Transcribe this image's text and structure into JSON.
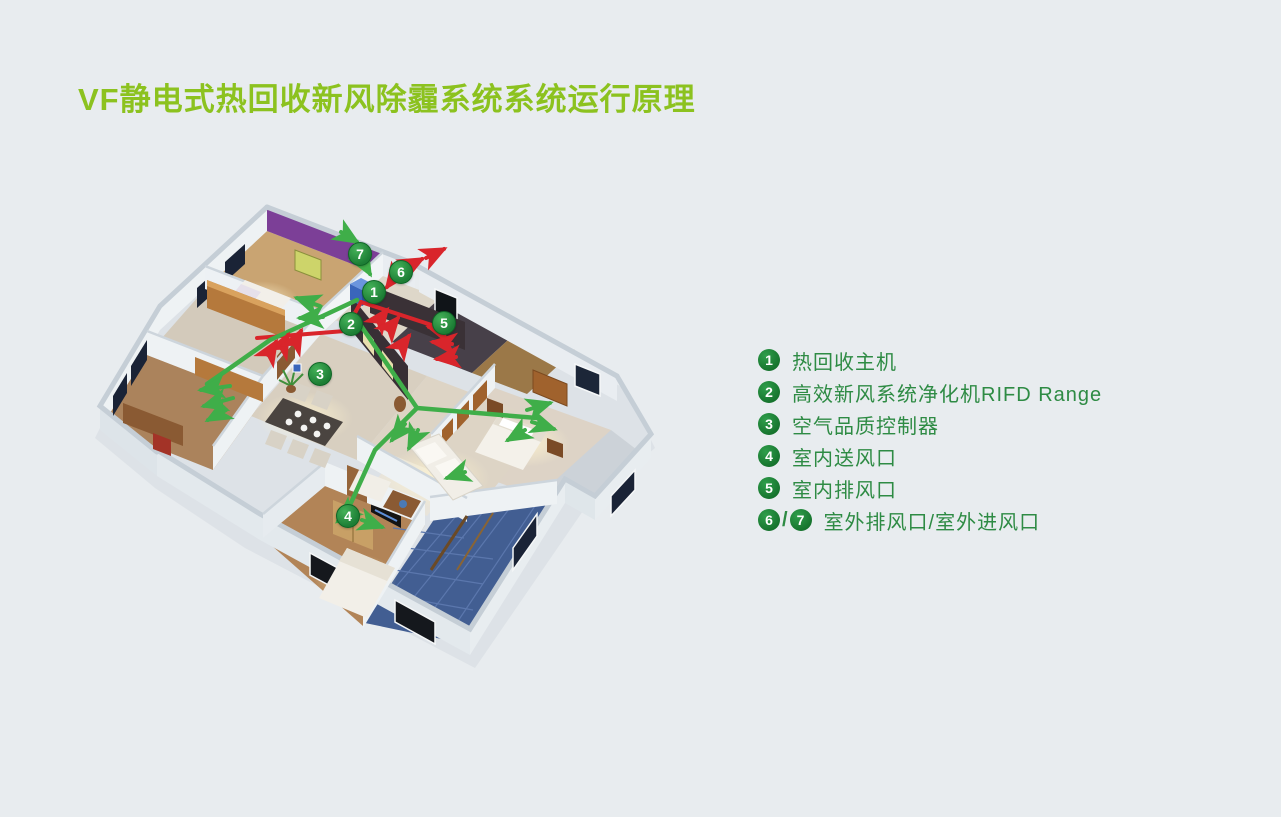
{
  "title": "VF静电式热回收新风除霾系统系统运行原理",
  "colors": {
    "background": "#e8ecef",
    "title_green": "#8cc21f",
    "legend_text_green": "#2e8b44",
    "badge_green": "#1d7e35",
    "supply_duct_green": "#3fae49",
    "exhaust_duct_red": "#d9252b",
    "unit_blue": "#3a66bb",
    "bathroom_tile_blue": "#425e92",
    "accent_wall_purple": "#7c3f97",
    "dark_feature_wall": "#382f35"
  },
  "floorplan": {
    "markers": [
      {
        "label": "1"
      },
      {
        "label": "2"
      },
      {
        "label": "3"
      },
      {
        "label": "4"
      },
      {
        "label": "5"
      },
      {
        "label": "6"
      },
      {
        "label": "7"
      }
    ]
  },
  "legend": {
    "items": [
      {
        "badges": [
          "1"
        ],
        "label": "热回收主机"
      },
      {
        "badges": [
          "2"
        ],
        "label": "高效新风系统净化机RIFD Range"
      },
      {
        "badges": [
          "3"
        ],
        "label": "空气品质控制器"
      },
      {
        "badges": [
          "4"
        ],
        "label": "室内送风口"
      },
      {
        "badges": [
          "5"
        ],
        "label": "室内排风口"
      },
      {
        "badges": [
          "6",
          "7"
        ],
        "separator": "/",
        "label": "室外排风口/室外进风口"
      }
    ]
  }
}
